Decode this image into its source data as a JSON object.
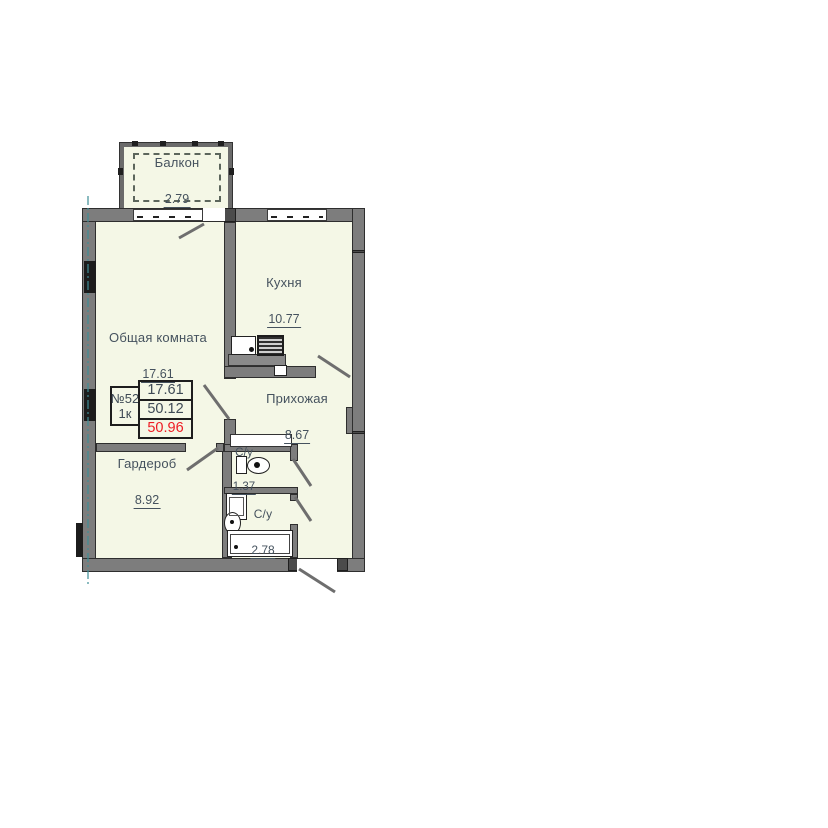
{
  "plan": {
    "unit_box": {
      "number": "№52",
      "type": "1к",
      "rows": [
        "17.61",
        "50.12",
        "50.96"
      ]
    },
    "rooms": {
      "balcony": {
        "name": "Балкон",
        "area": "2.79"
      },
      "kitchen": {
        "name": "Кухня",
        "area": "10.77"
      },
      "living": {
        "name": "Общая комната",
        "area": "17.61"
      },
      "hall": {
        "name": "Прихожая",
        "area": "8.67"
      },
      "wardrobe": {
        "name": "Гардероб",
        "area": "8.92"
      },
      "wc1": {
        "name": "С/у",
        "area": "1.37"
      },
      "wc2": {
        "name": "С/у",
        "area": "2.78"
      }
    },
    "colors": {
      "room_fill": "#f4f7e6",
      "wall_gray": "#7d7d7d",
      "accent_red": "#ee1d24",
      "axis_teal": "#3e8e96",
      "text": "#45525e"
    }
  }
}
